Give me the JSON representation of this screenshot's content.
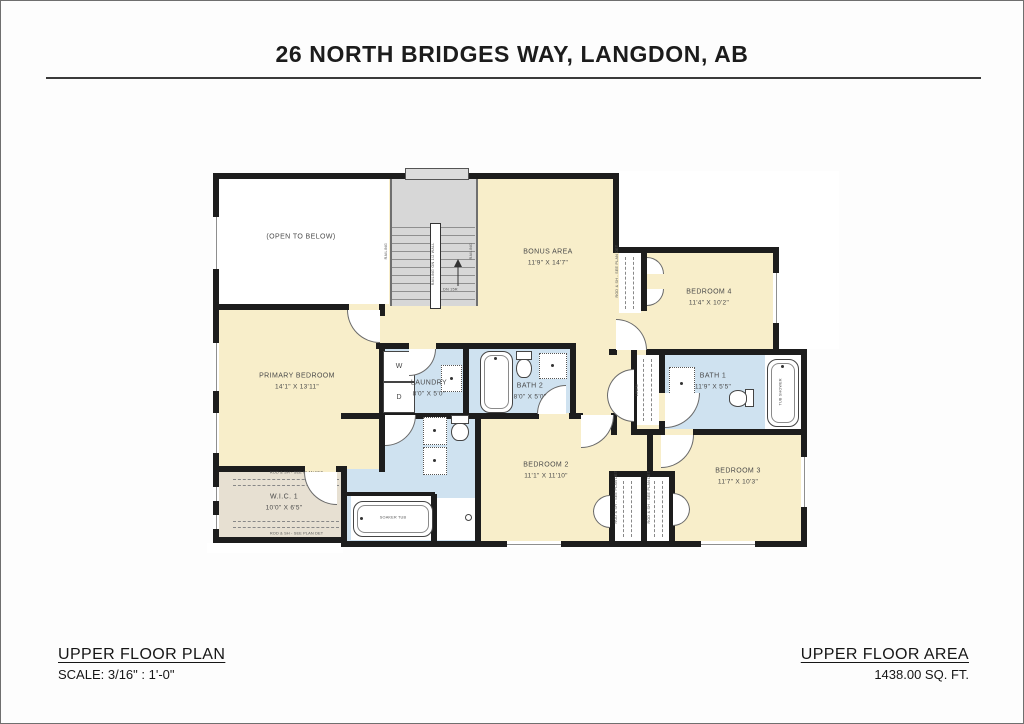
{
  "page": {
    "title": "26 NORTH BRIDGES WAY, LANGDON, AB"
  },
  "footer": {
    "plan_title": "UPPER FLOOR PLAN",
    "plan_scale": "SCALE: 3/16\" : 1'-0\"",
    "area_title": "UPPER FLOOR AREA",
    "area_value": "1438.00 SQ. FT."
  },
  "rooms": {
    "open_to_below": {
      "name": "(OPEN TO BELOW)"
    },
    "bonus_area": {
      "name": "BONUS AREA",
      "dims": "11'9\" X 14'7\""
    },
    "bedroom_4": {
      "name": "BEDROOM 4",
      "dims": "11'4\" X 10'2\""
    },
    "primary_bedroom": {
      "name": "PRIMARY BEDROOM",
      "dims": "14'1\" X 13'11\""
    },
    "laundry": {
      "name": "LAUNDRY",
      "dims": "8'0\" X 5'0\""
    },
    "bath_2": {
      "name": "BATH 2",
      "dims": "8'0\" X 5'0\""
    },
    "bath_1": {
      "name": "BATH 1",
      "dims": "11'9\" X 5'5\""
    },
    "wic_1": {
      "name": "W.I.C. 1",
      "dims": "10'0\" X 6'5\""
    },
    "bedroom_2": {
      "name": "BEDROOM 2",
      "dims": "11'1\" X 11'10\""
    },
    "bedroom_3": {
      "name": "BEDROOM 3",
      "dims": "11'7\" X 10'3\""
    }
  },
  "fixtures": {
    "washer": "W",
    "dryer": "D",
    "soaker_tub": "SOAKER TUB",
    "tub_shower": "TUB SHOWER",
    "linen": "LINEN",
    "stairs_down": "DN 15R",
    "railing": "RAILING",
    "railing_half_wall": "RAILING ON 1/2 WALL",
    "closet_rod_note": "ROD & SH - SEE PLAN DET"
  },
  "colors": {
    "wall": "#1d1d1d",
    "room_fill": "#f8eeca",
    "wet_room_fill": "#cfe2f0",
    "closet_fill": "#e7e0d2",
    "stairs_fill": "#d7d7d7"
  }
}
